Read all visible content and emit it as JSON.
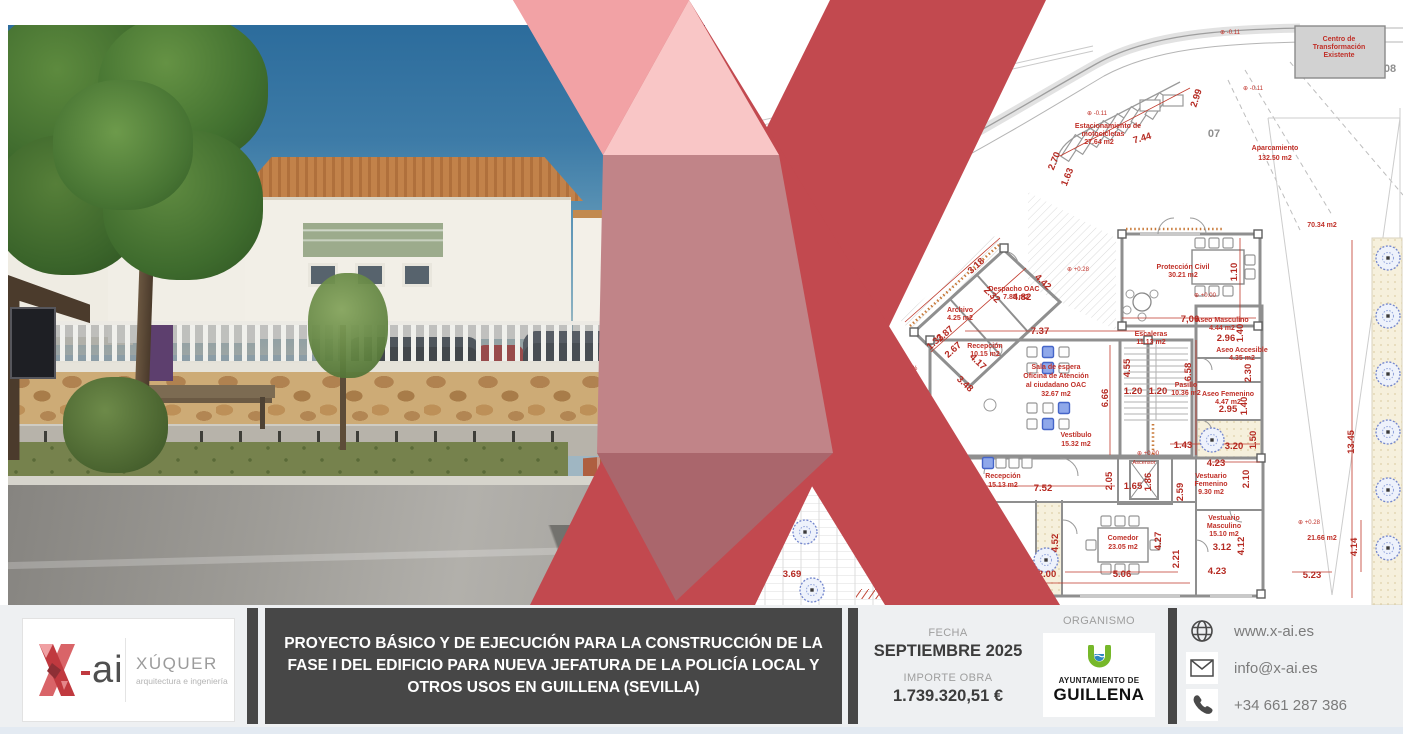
{
  "project": {
    "title": "PROYECTO BÁSICO Y DE EJECUCIÓN PARA LA CONSTRUCCIÓN DE LA FASE I DEL EDIFICIO PARA NUEVA JEFATURA DE LA POLICÍA LOCAL Y OTROS USOS EN GUILLENA (SEVILLA)",
    "fecha_label": "FECHA",
    "fecha_value": "SEPTIEMBRE 2025",
    "importe_label": "IMPORTE OBRA",
    "importe_value": "1.739.320,51 €",
    "organismo_label": "ORGANISMO"
  },
  "brand": {
    "logo_ai": "ai",
    "firm_name": "XÚQUER",
    "firm_tagline": "arquitectura e ingeniería"
  },
  "organismo_logo": {
    "line1": "AYUNTAMIENTO DE",
    "line2": "GUILLENA"
  },
  "contact": {
    "website": "www.x-ai.es",
    "email": "info@x-ai.es",
    "phone": "+34 661 287 386"
  },
  "colors": {
    "brand_red": "#c2494f",
    "pink_light": "#f9c6c6",
    "pink_mid": "#f2a2a5",
    "rose_overlap": "#c18488",
    "dark_box": "#474747",
    "plan_red": "#c03028",
    "guillena_green": "#76b82a",
    "guillena_blue": "#2e86c1"
  },
  "plan": {
    "texts": [
      {
        "t": "Centro de",
        "x": 1339,
        "y": 41
      },
      {
        "t": "Transformación",
        "x": 1339,
        "y": 49
      },
      {
        "t": "Existente",
        "x": 1339,
        "y": 57
      },
      {
        "t": "Estacionamiento de",
        "x": 1108,
        "y": 128
      },
      {
        "t": "motocicletas",
        "x": 1103,
        "y": 136
      },
      {
        "t": "27.64 m2",
        "x": 1099,
        "y": 144
      },
      {
        "t": "Aparcamiento",
        "x": 1275,
        "y": 150
      },
      {
        "t": "132.50 m2",
        "x": 1275,
        "y": 160
      },
      {
        "t": "Protección Civil",
        "x": 1183,
        "y": 269
      },
      {
        "t": "30.21 m2",
        "x": 1183,
        "y": 277
      },
      {
        "t": "Escaleras",
        "x": 1151,
        "y": 336
      },
      {
        "t": "11.13 m2",
        "x": 1151,
        "y": 344
      },
      {
        "t": "Aseo Masculino",
        "x": 1222,
        "y": 322
      },
      {
        "t": "4.44 m2",
        "x": 1222,
        "y": 330
      },
      {
        "t": "Aseo Accesible",
        "x": 1242,
        "y": 352
      },
      {
        "t": "4.35 m2",
        "x": 1242,
        "y": 360
      },
      {
        "t": "Pasillo",
        "x": 1186,
        "y": 387
      },
      {
        "t": "10.36 m2",
        "x": 1186,
        "y": 395
      },
      {
        "t": "Aseo Femenino",
        "x": 1228,
        "y": 396
      },
      {
        "t": "4.47 m2",
        "x": 1228,
        "y": 404
      },
      {
        "t": "Vestíbulo",
        "x": 1076,
        "y": 437
      },
      {
        "t": "15.32 m2",
        "x": 1076,
        "y": 446
      },
      {
        "t": "Archivo",
        "x": 960,
        "y": 312
      },
      {
        "t": "4.25 m2",
        "x": 960,
        "y": 320
      },
      {
        "t": "Despacho OAC",
        "x": 1014,
        "y": 291
      },
      {
        "t": "7.85 m2",
        "x": 1016,
        "y": 299
      },
      {
        "t": "Recepción",
        "x": 985,
        "y": 348
      },
      {
        "t": "10.15 m2",
        "x": 985,
        "y": 356
      },
      {
        "t": "Sala de espera",
        "x": 1056,
        "y": 369
      },
      {
        "t": "Oficina de Atención",
        "x": 1056,
        "y": 378
      },
      {
        "t": "al ciudadano OAC",
        "x": 1056,
        "y": 387
      },
      {
        "t": "32.67 m2",
        "x": 1056,
        "y": 396
      },
      {
        "t": "Recepción",
        "x": 1003,
        "y": 478
      },
      {
        "t": "15.13 m2",
        "x": 1003,
        "y": 487
      },
      {
        "t": "Ascensor",
        "x": 1144,
        "y": 464,
        "c": "rs"
      },
      {
        "t": "Despacho 03",
        "x": 979,
        "y": 515
      },
      {
        "t": "11.73 m2",
        "x": 979,
        "y": 524
      },
      {
        "t": "Comedor",
        "x": 1123,
        "y": 540
      },
      {
        "t": "23.05 m2",
        "x": 1123,
        "y": 549
      },
      {
        "t": "Vestuario",
        "x": 1211,
        "y": 478
      },
      {
        "t": "Femenino",
        "x": 1211,
        "y": 486
      },
      {
        "t": "9.30 m2",
        "x": 1211,
        "y": 494
      },
      {
        "t": "Vestuario",
        "x": 1224,
        "y": 520
      },
      {
        "t": "Masculino",
        "x": 1224,
        "y": 528
      },
      {
        "t": "15.10 m2",
        "x": 1224,
        "y": 536
      },
      {
        "t": "70.34 m2",
        "x": 1322,
        "y": 227
      },
      {
        "t": "21.66 m2",
        "x": 1322,
        "y": 540
      },
      {
        "t": "4%",
        "x": 913,
        "y": 370,
        "c": "lv"
      },
      {
        "t": "07",
        "x": 1214,
        "y": 137,
        "c": "gl"
      },
      {
        "t": "08",
        "x": 1390,
        "y": 72,
        "c": "gl"
      },
      {
        "t": "7.44",
        "x": 1143,
        "y": 141,
        "c": "dm",
        "r": -16
      },
      {
        "t": "2.99",
        "x": 1199,
        "y": 99,
        "c": "dm",
        "r": -72
      },
      {
        "t": "2.70",
        "x": 1057,
        "y": 162,
        "c": "dm",
        "r": -68
      },
      {
        "t": "1.63",
        "x": 1070,
        "y": 178,
        "c": "dm",
        "r": -68
      },
      {
        "t": "7,06",
        "x": 1190,
        "y": 322,
        "c": "dm"
      },
      {
        "t": "1.10",
        "x": 1237,
        "y": 272,
        "c": "dm",
        "r": -90
      },
      {
        "t": "7.37",
        "x": 1040,
        "y": 334,
        "c": "dm"
      },
      {
        "t": "4.82",
        "x": 1022,
        "y": 300,
        "c": "dm"
      },
      {
        "t": "3.18",
        "x": 978,
        "y": 268,
        "c": "dm",
        "r": -42
      },
      {
        "t": "4.42",
        "x": 1041,
        "y": 284,
        "c": "dm",
        "r": 43
      },
      {
        "t": "2.32",
        "x": 990,
        "y": 297,
        "c": "dm",
        "r": 43
      },
      {
        "t": "2.87",
        "x": 947,
        "y": 336,
        "c": "dm",
        "r": -42
      },
      {
        "t": "1.33",
        "x": 937,
        "y": 344,
        "c": "dm",
        "r": -42
      },
      {
        "t": "2.67",
        "x": 955,
        "y": 352,
        "c": "dm",
        "r": -42
      },
      {
        "t": "4.17",
        "x": 976,
        "y": 364,
        "c": "dm",
        "r": 43
      },
      {
        "t": "3.48",
        "x": 963,
        "y": 386,
        "c": "dm",
        "r": 43
      },
      {
        "t": "4.55",
        "x": 1130,
        "y": 368,
        "c": "dm",
        "r": -90
      },
      {
        "t": "6.66",
        "x": 1108,
        "y": 398,
        "c": "dm",
        "r": -90
      },
      {
        "t": "1.20",
        "x": 1133,
        "y": 394,
        "c": "dm"
      },
      {
        "t": "1.20",
        "x": 1158,
        "y": 394,
        "c": "dm"
      },
      {
        "t": "6.58",
        "x": 1191,
        "y": 372,
        "c": "dm",
        "r": -90
      },
      {
        "t": "2.96",
        "x": 1226,
        "y": 341,
        "c": "dm"
      },
      {
        "t": "1.40",
        "x": 1243,
        "y": 333,
        "c": "dm",
        "r": -90
      },
      {
        "t": "2.30",
        "x": 1251,
        "y": 373,
        "c": "dm",
        "r": -90
      },
      {
        "t": "1.40",
        "x": 1247,
        "y": 406,
        "c": "dm",
        "r": -90
      },
      {
        "t": "2.95",
        "x": 1228,
        "y": 412,
        "c": "dm"
      },
      {
        "t": "1.50",
        "x": 1256,
        "y": 440,
        "c": "dm",
        "r": -90
      },
      {
        "t": "3.20",
        "x": 1234,
        "y": 449,
        "c": "dm"
      },
      {
        "t": "1.43",
        "x": 1183,
        "y": 448,
        "c": "dm"
      },
      {
        "t": "4.23",
        "x": 1216,
        "y": 466,
        "c": "dm"
      },
      {
        "t": "2.10",
        "x": 1249,
        "y": 479,
        "c": "dm",
        "r": -90
      },
      {
        "t": "2.59",
        "x": 1183,
        "y": 492,
        "c": "dm",
        "r": -90
      },
      {
        "t": "7.52",
        "x": 1043,
        "y": 491,
        "c": "dm"
      },
      {
        "t": "2.05",
        "x": 1112,
        "y": 481,
        "c": "dm",
        "r": -90
      },
      {
        "t": "1.65",
        "x": 1133,
        "y": 489,
        "c": "dm"
      },
      {
        "t": "1.86",
        "x": 1151,
        "y": 482,
        "c": "dm",
        "r": -90
      },
      {
        "t": "4.27",
        "x": 1014,
        "y": 543,
        "c": "dm",
        "r": -90
      },
      {
        "t": "4.52",
        "x": 1058,
        "y": 543,
        "c": "dm",
        "r": -90
      },
      {
        "t": "2.00",
        "x": 1047,
        "y": 577,
        "c": "dm"
      },
      {
        "t": "5.06",
        "x": 1122,
        "y": 577,
        "c": "dm"
      },
      {
        "t": "4.27",
        "x": 1161,
        "y": 541,
        "c": "dm",
        "r": -90
      },
      {
        "t": "2.21",
        "x": 1179,
        "y": 559,
        "c": "dm",
        "r": -90
      },
      {
        "t": "3.12",
        "x": 1222,
        "y": 550,
        "c": "dm"
      },
      {
        "t": "4.12",
        "x": 1244,
        "y": 546,
        "c": "dm",
        "r": -90
      },
      {
        "t": "4.23",
        "x": 1217,
        "y": 574,
        "c": "dm"
      },
      {
        "t": "3.69",
        "x": 792,
        "y": 577,
        "c": "dm"
      },
      {
        "t": "13.45",
        "x": 1354,
        "y": 442,
        "c": "dm",
        "r": -90
      },
      {
        "t": "4.14",
        "x": 1357,
        "y": 547,
        "c": "dm",
        "r": -90
      },
      {
        "t": "5.23",
        "x": 1312,
        "y": 578,
        "c": "dm"
      },
      {
        "t": "⊕ -0.11",
        "x": 1230,
        "y": 34,
        "c": "lv"
      },
      {
        "t": "⊕ -0.11",
        "x": 1097,
        "y": 115,
        "c": "lv"
      },
      {
        "t": "⊕ -0.11",
        "x": 1253,
        "y": 90,
        "c": "lv"
      },
      {
        "t": "⊕ +0.00",
        "x": 1205,
        "y": 297,
        "c": "lv"
      },
      {
        "t": "⊕ +0.00",
        "x": 1148,
        "y": 455,
        "c": "lv"
      },
      {
        "t": "⊕ +0.28",
        "x": 1309,
        "y": 524,
        "c": "lv"
      },
      {
        "t": "⊕ +0.28",
        "x": 1078,
        "y": 271,
        "c": "lv"
      }
    ]
  }
}
